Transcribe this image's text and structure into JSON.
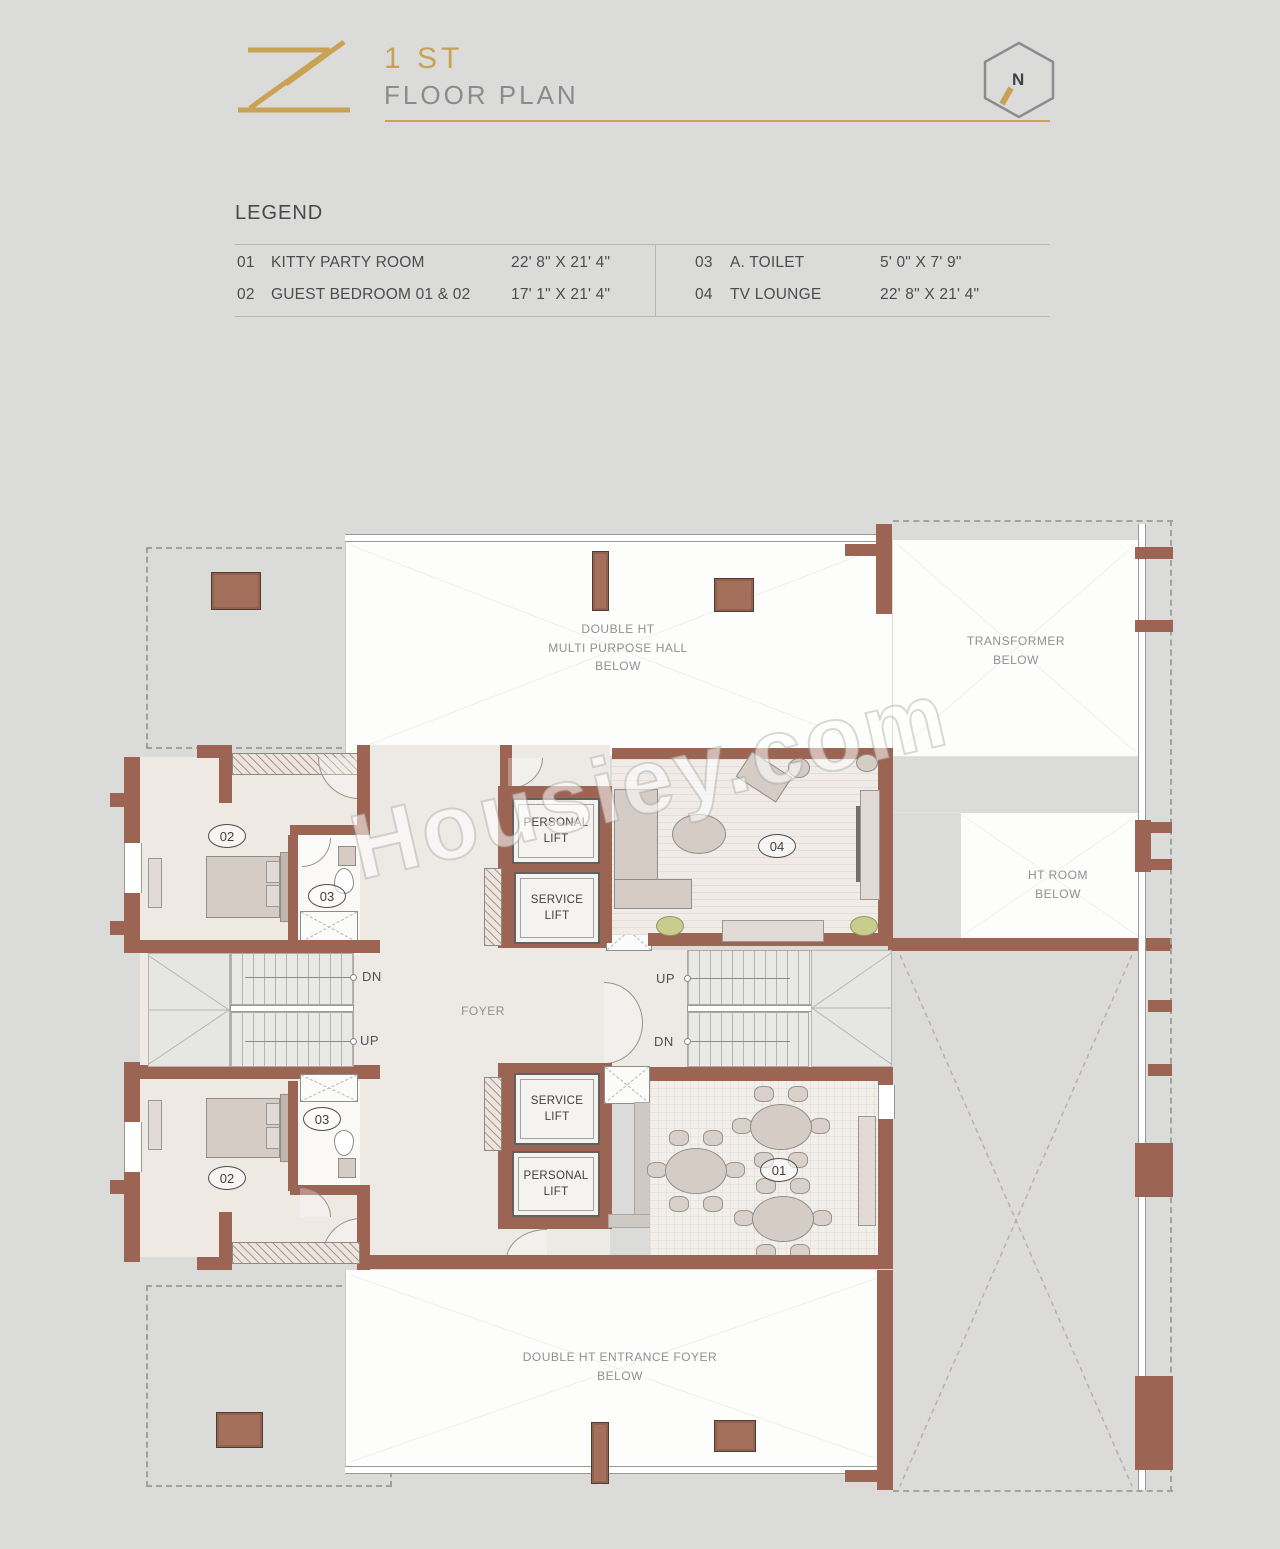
{
  "header": {
    "logo_letter": "Z",
    "title": "1 ST",
    "subtitle": "FLOOR PLAN",
    "north_label": "N"
  },
  "legend": {
    "heading": "LEGEND",
    "items": [
      {
        "num": "01",
        "name": "KITTY PARTY ROOM",
        "dim": "22' 8\" X 21' 4\""
      },
      {
        "num": "02",
        "name": "GUEST BEDROOM 01 & 02",
        "dim": "17' 1\" X 21' 4\""
      },
      {
        "num": "03",
        "name": "A. TOILET",
        "dim": "5' 0\" X 7' 9\""
      },
      {
        "num": "04",
        "name": "TV LOUNGE",
        "dim": "22' 8\" X 21' 4\""
      }
    ]
  },
  "plan": {
    "labels": {
      "hall": "DOUBLE HT\nMULTI PURPOSE HALL\nBELOW",
      "transformer": "TRANSFORMER\nBELOW",
      "ht_room": "HT ROOM\nBELOW",
      "entrance_foyer": "DOUBLE HT ENTRANCE FOYER\nBELOW",
      "foyer": "FOYER",
      "personal_lift": "PERSONAL\nLIFT",
      "service_lift": "SERVICE\nLIFT",
      "up": "UP",
      "dn": "DN",
      "room_01": "01",
      "room_02": "02",
      "room_03": "03",
      "room_04": "04"
    }
  },
  "watermark": "Housiey.com",
  "colors": {
    "wall": "#9c6553",
    "accent_gold": "#c8a254",
    "background": "#dbdcda",
    "plant_green": "#c9cd8b"
  }
}
